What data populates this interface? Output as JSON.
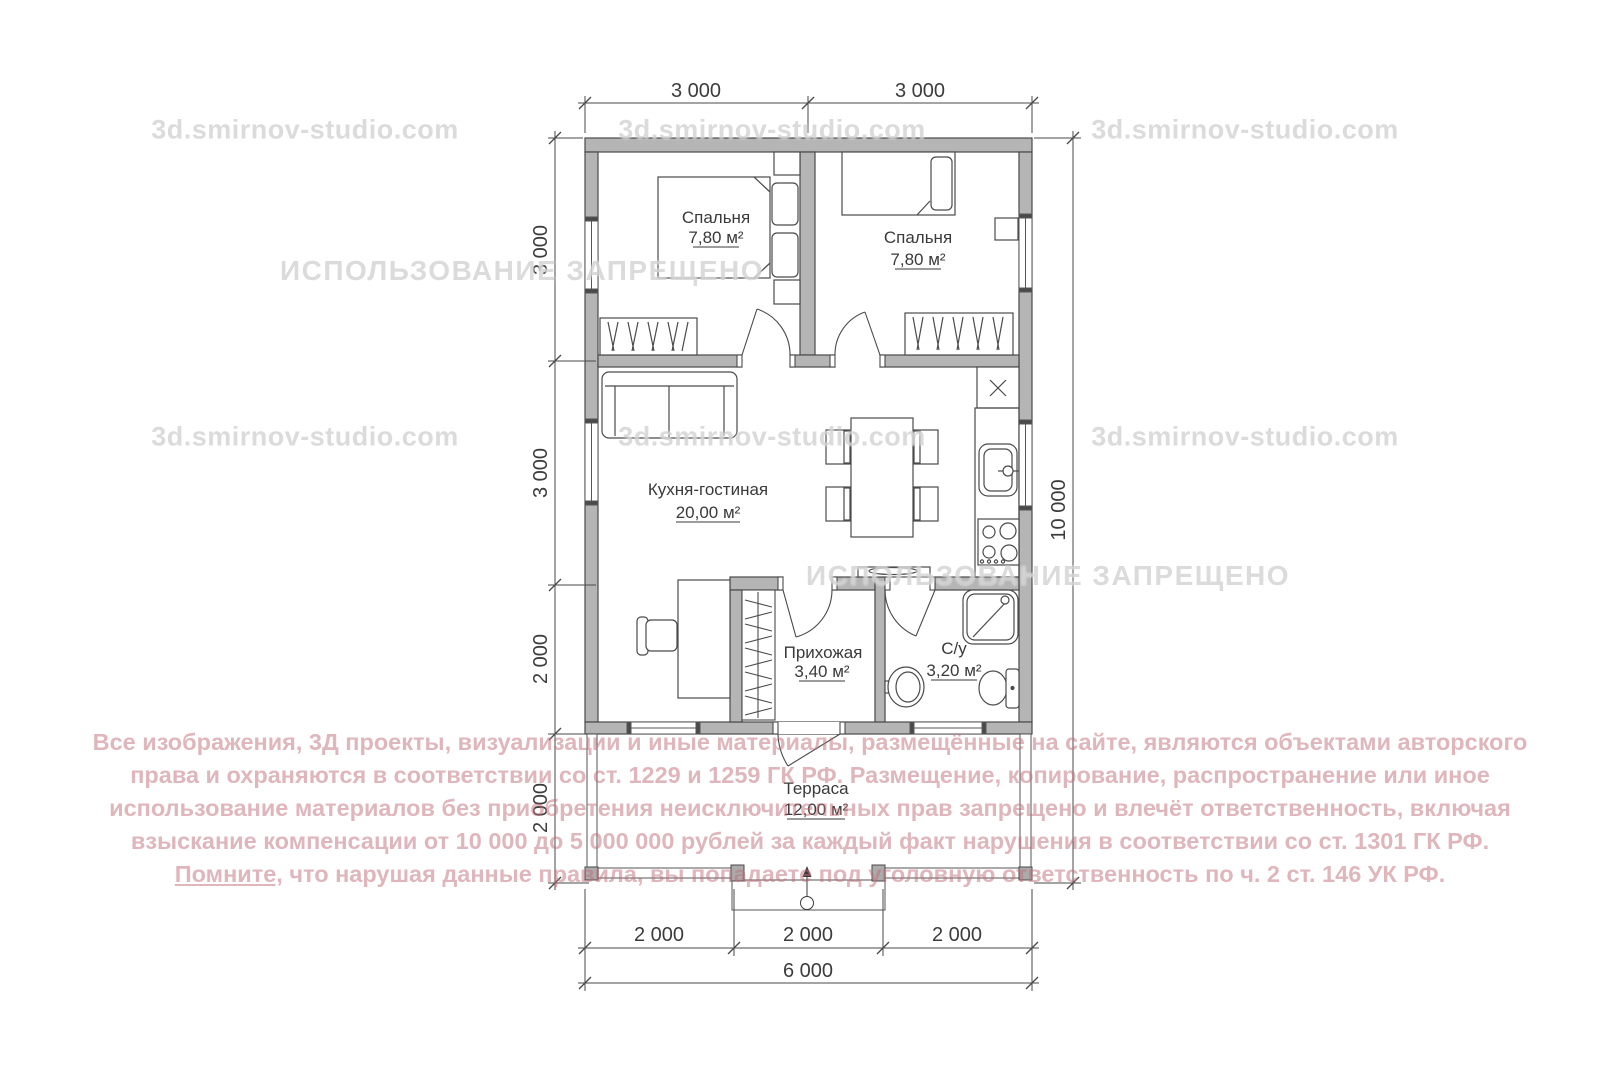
{
  "watermarks": {
    "site": "3d.smirnov-studio.com",
    "forbidden": "ИСПОЛЬЗОВАНИЕ ЗАПРЕЩЕНО"
  },
  "rooms": {
    "bedroom1": {
      "name": "Спальня",
      "area": "7,80 м²"
    },
    "bedroom2": {
      "name": "Спальня",
      "area": "7,80 м²"
    },
    "living": {
      "name": "Кухня-гостиная",
      "area": "20,00 м²"
    },
    "hallway": {
      "name": "Прихожая",
      "area": "3,40 м²"
    },
    "bathroom": {
      "name": "С/у",
      "area": "3,20 м²"
    },
    "terrace": {
      "name": "Терраса",
      "area": "12,00 м²"
    }
  },
  "dimensions": {
    "top1": "3 000",
    "top2": "3 000",
    "left1": "3 000",
    "left2": "3 000",
    "left3": "2 000",
    "left4": "2 000",
    "right": "10 000",
    "bottom1": "2 000",
    "bottom2": "2 000",
    "bottom3": "2 000",
    "bottom_total": "6 000"
  },
  "legal": {
    "line1": "Все изображения, 3Д проекты, визуализации и иные материалы, размещённые на сайте, являются объектами авторского",
    "line2": "права и охраняются в соответствии со ст. 1229 и 1259 ГК РФ. Размещение, копирование, распространение или иное",
    "line3": "использование материалов без приобретения неисключительных прав запрещено и влечёт ответственность, включая",
    "line4": "взыскание компенсации от 10 000 до 5 000 000 рублей за каждый факт нарушения в соответствии со ст. 1301 ГК РФ.",
    "line5_underlined": "Помните,",
    "line5_rest": " что нарушая данные правила, вы попадаете под уголовную ответственность по ч. 2 ст. 146 УК РФ."
  },
  "colors": {
    "wall_fill": "#b5b5b5",
    "line": "#4a4a4a",
    "watermark_gray": "#c5c5c5",
    "legal_red": "#c06e78"
  }
}
